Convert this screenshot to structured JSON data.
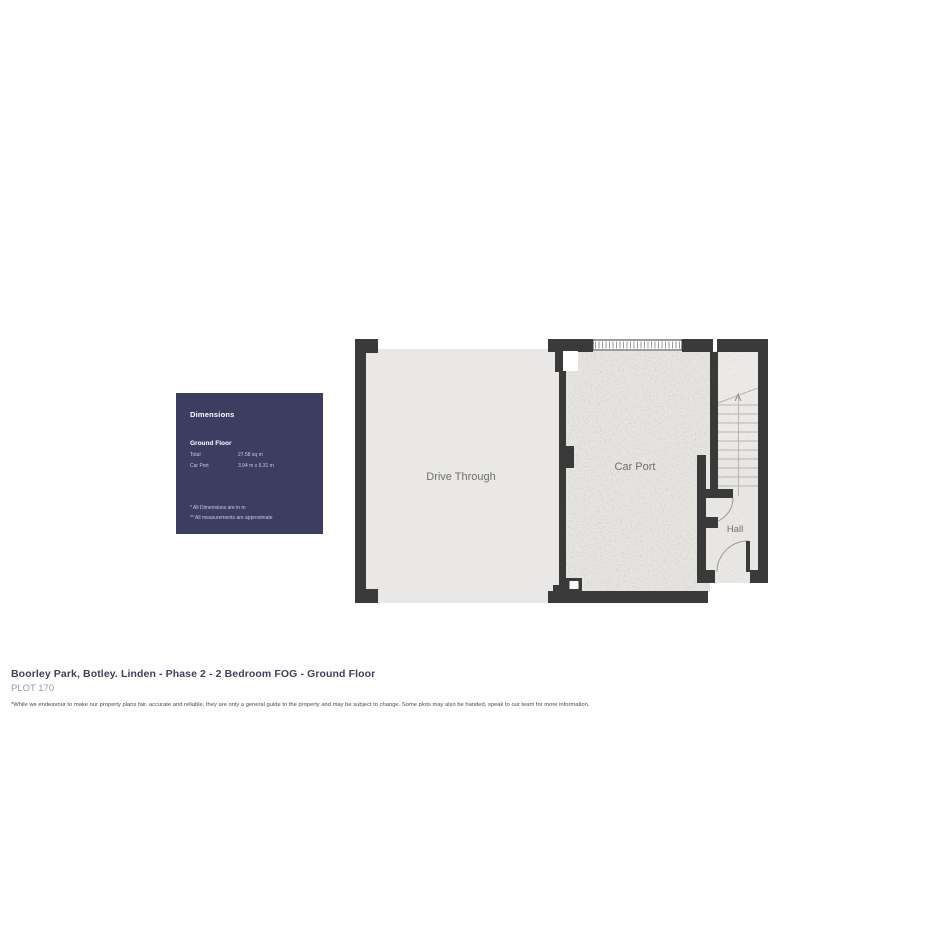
{
  "panel": {
    "title": "Dimensions",
    "section": "Ground Floor",
    "rows": [
      {
        "label": "Total",
        "value": "27.58 sq m"
      },
      {
        "label": "Car Port",
        "value": "3.94 m x 6.31 m"
      }
    ],
    "footnote1": "* All Dimensions are in m",
    "footnote2": "** All measurements are approximate",
    "bg_color": "#3d3c61"
  },
  "plan": {
    "rooms": [
      {
        "name": "Drive Through"
      },
      {
        "name": "Car Port"
      },
      {
        "name": "Hall"
      }
    ],
    "wall_color": "#3a3a3a",
    "floor_color": "#e9e8e6"
  },
  "caption": {
    "title": "Boorley Park, Botley. Linden - Phase 2 - 2 Bedroom FOG - Ground Floor",
    "plot": "PLOT 170",
    "disclaimer": "*While we endeavour to make our property plans fair, accurate and reliable, they are only a general guide to the property and may be subject to change. Some plots may also be handed, speak to our team for more information."
  }
}
